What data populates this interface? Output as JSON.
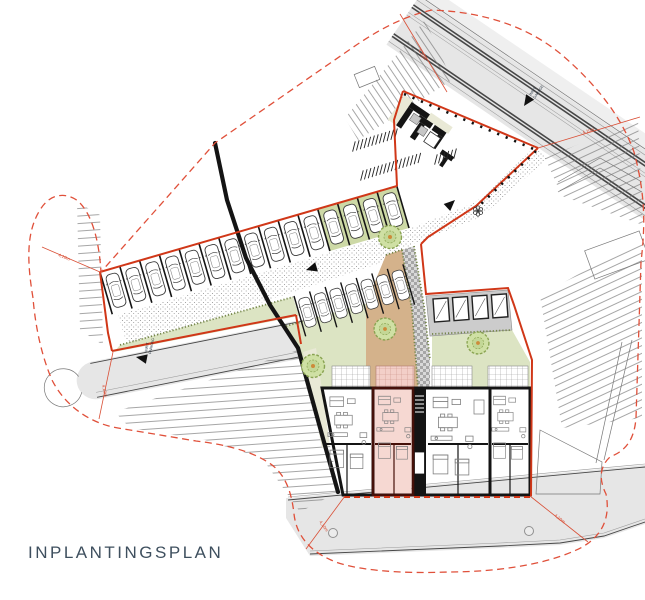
{
  "title": {
    "label": "INPLANTINGSPLAN"
  },
  "annotations": {
    "garage_entrance": {
      "line1": "INRIT",
      "line2": "GARAGE"
    },
    "parking_entrance": {
      "line1": "INRIT",
      "line2": "PARKING"
    },
    "dims": [
      "4,10m",
      "4,10m",
      "4,10m",
      "4,10m",
      "4,10m",
      "4,10m"
    ]
  },
  "parking": {
    "row1": {
      "stalls": 15,
      "green_last": 4
    },
    "row2": {
      "stalls": 7
    },
    "bike_racks": [
      12,
      16,
      6
    ]
  },
  "building": {
    "units": 4,
    "highlighted_unit": 2,
    "sheds": 4,
    "trees": 4
  },
  "site": {
    "manholes": 2
  },
  "colors": {
    "boundary_red": "#d03718",
    "dashed_red": "#e0503a",
    "dim_red": "#d94f36",
    "road_grey": "#e6e6e6",
    "sidewalk_grey": "#efefef",
    "road_edge": "#474747",
    "wall_black": "#141414",
    "garden_green": "#dce4c3",
    "parking_green": "#cdd9a6",
    "garden_tan": "#d4b28b",
    "pink_fill": "#f6d8d2",
    "pink_wall": "#451009",
    "pink_grid": "#cb9288",
    "tree_fill": "#cfe0a4",
    "tree_edge": "#89a351",
    "tree_core": "#cd8b3a",
    "stipple_dot": "#8f8f8f",
    "hatch_line": "#757575",
    "checker_dark": "#a6a6a6",
    "checker_light": "#d9d9d9",
    "grid_line": "#9a9a9a",
    "hedge_green": "#75864a",
    "cream": "#e9e9d6",
    "furniture_grey": "#7e7e7e",
    "shed_strip": "#cccccc",
    "title_color": "#3e4f5e",
    "label_navy": "#1c2b3a"
  }
}
